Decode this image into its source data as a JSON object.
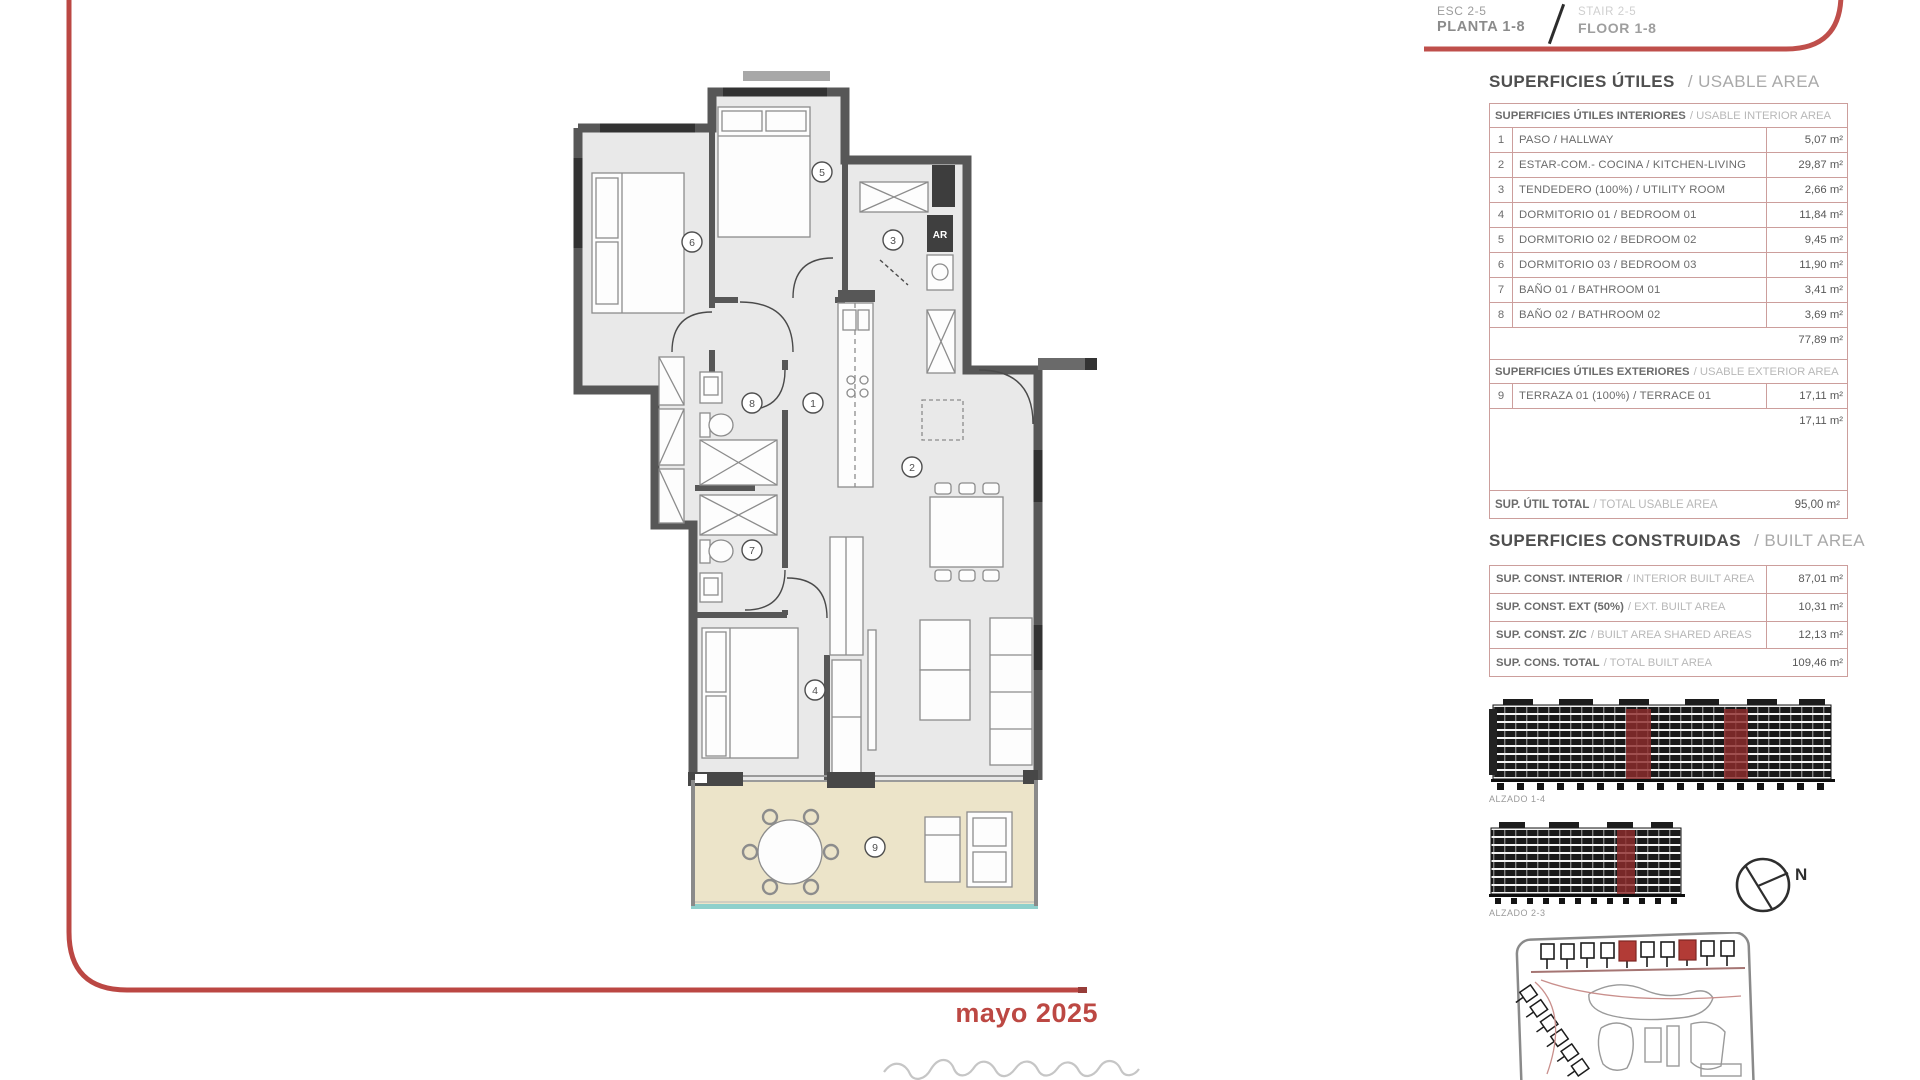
{
  "title_block": {
    "esc": "ESC 2-5",
    "planta": "PLANTA 1-8",
    "stair": "STAIR 2-5",
    "floor": "FLOOR 1-8"
  },
  "usable_area": {
    "title_es": "SUPERFICIES ÚTILES",
    "title_en": "/ USABLE AREA",
    "interior_header_es": "SUPERFICIES ÚTILES INTERIORES",
    "interior_header_en": "/ USABLE INTERIOR AREA",
    "interior_rows": [
      {
        "num": "1",
        "name": "PASO / HALLWAY",
        "area": "5,07 m²"
      },
      {
        "num": "2",
        "name": "ESTAR-COM.- COCINA / KITCHEN-LIVING",
        "area": "29,87 m²"
      },
      {
        "num": "3",
        "name": "TENDEDERO (100%) / UTILITY ROOM",
        "area": "2,66 m²"
      },
      {
        "num": "4",
        "name": "DORMITORIO 01 / BEDROOM 01",
        "area": "11,84 m²"
      },
      {
        "num": "5",
        "name": "DORMITORIO 02 / BEDROOM 02",
        "area": "9,45 m²"
      },
      {
        "num": "6",
        "name": "DORMITORIO 03 / BEDROOM 03",
        "area": "11,90 m²"
      },
      {
        "num": "7",
        "name": "BAÑO 01 / BATHROOM 01",
        "area": "3,41 m²"
      },
      {
        "num": "8",
        "name": "BAÑO 02 / BATHROOM 02",
        "area": "3,69 m²"
      }
    ],
    "interior_subtotal": "77,89 m²",
    "exterior_header_es": "SUPERFICIES ÚTILES EXTERIORES",
    "exterior_header_en": "/ USABLE EXTERIOR AREA",
    "exterior_rows": [
      {
        "num": "9",
        "name": "TERRAZA 01 (100%) / TERRACE 01",
        "area": "17,11 m²"
      }
    ],
    "exterior_subtotal": "17,11 m²",
    "total_es": "SUP. ÚTIL TOTAL",
    "total_en": "/ TOTAL USABLE AREA",
    "total_area": "95,00 m²"
  },
  "built_area": {
    "title_es": "SUPERFICIES CONSTRUIDAS",
    "title_en": "/ BUILT AREA",
    "rows": [
      {
        "label_es": "SUP. CONST. INTERIOR",
        "label_en": "/ INTERIOR BUILT AREA",
        "area": "87,01 m²"
      },
      {
        "label_es": "SUP. CONST. EXT (50%)",
        "label_en": "/ EXT. BUILT AREA",
        "area": "10,31 m²"
      },
      {
        "label_es": "SUP. CONST. Z/C",
        "label_en": "/ BUILT AREA SHARED AREAS",
        "area": "12,13 m²"
      }
    ],
    "total_es": "SUP. CONS. TOTAL",
    "total_en": "/ TOTAL BUILT AREA",
    "total_area": "109,46 m²"
  },
  "elevations": {
    "alzado1": "ALZADO 1-4",
    "alzado2": "ALZADO 2-3"
  },
  "compass": {
    "north": "N"
  },
  "date": "mayo 2025",
  "plan": {
    "ar_label": "AR",
    "numbers": [
      "1",
      "2",
      "3",
      "4",
      "5",
      "6",
      "7",
      "8",
      "9"
    ]
  }
}
